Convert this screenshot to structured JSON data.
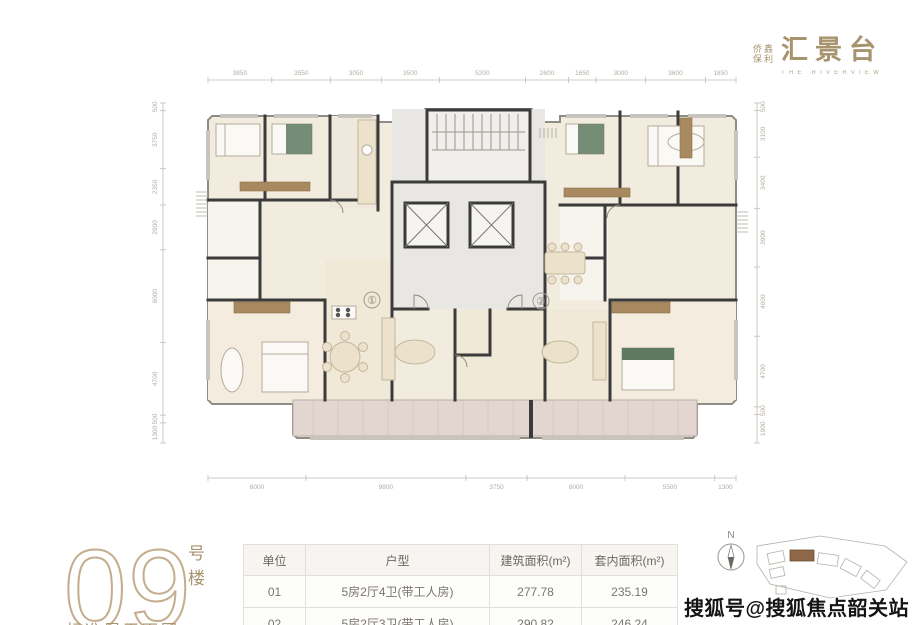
{
  "colors": {
    "brand": "#a8936f",
    "wall": "#3b3b3b",
    "beige": "#f2ecdf",
    "beige2": "#ece3d1",
    "core": "#e9e7e3",
    "balcony": "#e3d5d0",
    "green": "#5d7a60",
    "brown": "#a98a60",
    "dim": "#b3aca1"
  },
  "brand": {
    "small_line1": "侨鑫",
    "small_line2": "保利",
    "name": "汇景台",
    "tagline": "THE RIVERVIEW"
  },
  "building": {
    "number": "09",
    "suffix": "号楼",
    "caption": "标准层平面图"
  },
  "plan": {
    "compass_label": "N",
    "unit_labels": [
      "②",
      "①"
    ],
    "dims_top": [
      "3850",
      "3550",
      "3050",
      "3500",
      "5200",
      "2600",
      "1650",
      "3000",
      "3600",
      "1850"
    ],
    "dims_bottom": [
      "6000",
      "9800",
      "3750",
      "6000",
      "5500",
      "1300"
    ],
    "dims_left": [
      "500",
      "3750",
      "2350",
      "2900",
      "6000",
      "4700",
      "500",
      "1300"
    ],
    "dims_right": [
      "500",
      "3100",
      "3400",
      "3900",
      "4600",
      "4700",
      "500",
      "1900"
    ]
  },
  "table": {
    "headers": [
      "单位",
      "户型",
      "建筑面积(m²)",
      "套内面积(m²)"
    ],
    "rows": [
      [
        "01",
        "5房2厅4卫(带工人房)",
        "277.78",
        "235.19"
      ],
      [
        "02",
        "5房2厅3卫(带工人房)",
        "290.82",
        "246.24"
      ]
    ]
  },
  "watermark": "搜狐号@搜狐焦点韶关站"
}
